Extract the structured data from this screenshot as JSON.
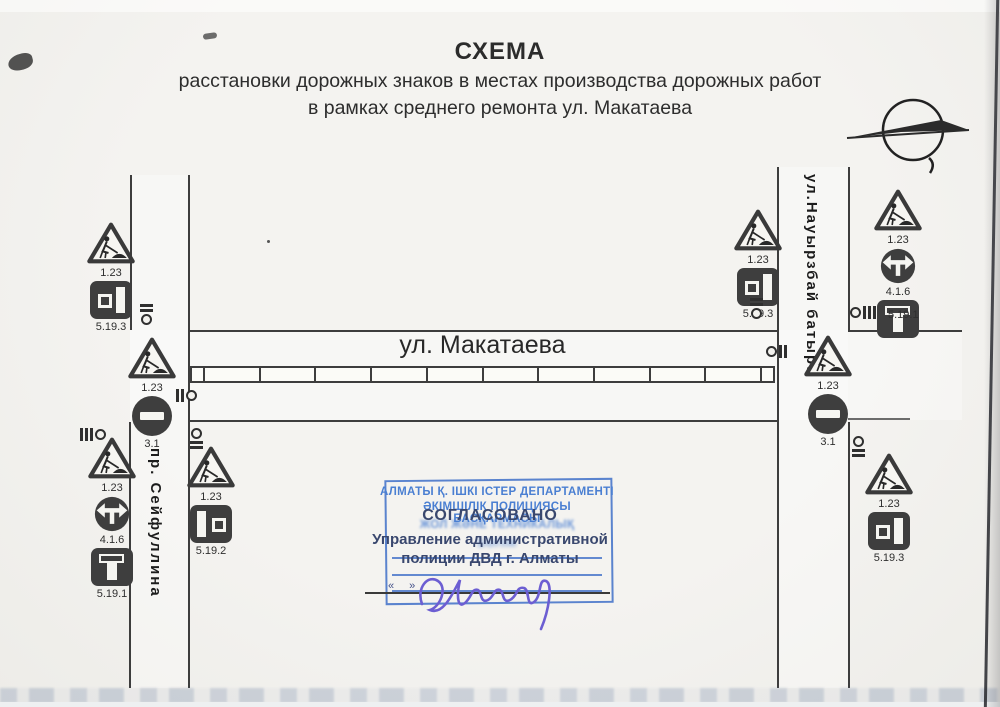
{
  "page": {
    "title_heading": "СХЕМА",
    "title_line2": "расстановки дорожных знаков в местах производства дорожных работ",
    "title_line3": "в рамках среднего ремонта ул. Макатаева"
  },
  "streets": {
    "makataeva": "ул. Макатаева",
    "seifullina": "пр. Сейфуллина",
    "nauryzbai": "ул.Науырзбай батыра"
  },
  "groups": {
    "nw": {
      "labels": [
        "1.23",
        "5.19.3"
      ]
    },
    "w_mid": {
      "labels": [
        "1.23",
        "3.1"
      ]
    },
    "sw_west": {
      "labels": [
        "1.23",
        "4.1.6",
        "5.19.1"
      ]
    },
    "sw_east": {
      "labels": [
        "1.23",
        "5.19.2"
      ]
    },
    "ne_west": {
      "labels": [
        "1.23",
        "5.19.3"
      ]
    },
    "e_mid": {
      "labels": [
        "1.23",
        "3.1"
      ]
    },
    "ne_far": {
      "labels": [
        "1.23",
        "4.1.6",
        "5.19.1"
      ]
    },
    "se": {
      "labels": [
        "1.23",
        "5.19.3"
      ]
    }
  },
  "stamp": {
    "kz_line1": "АЛМАТЫ Қ. ІШКІ ІСТЕР ДЕПАРТАМЕНТІ",
    "kz_line2": "ӘКІМШІЛІК ПОЛИЦИЯСЫ БАСҚАРМАСЫ",
    "kz_line3": "ЖОЛ ЖӘНЕ ТЕХНИКАЛЫҚ",
    "kz_line4": "БӨЛІМ",
    "approved": "СОГЛАСОВАНО",
    "approved_org1": "Управление административной",
    "approved_org2": "полиции ДВД г. Алматы",
    "date_marks": "«  »"
  },
  "colors": {
    "paper": "#f2f1ed",
    "ink": "#3d3d3d",
    "stamp_blue": "#4a7fd2",
    "stamp_dark": "#39476e",
    "signature": "#6c5ed2"
  }
}
